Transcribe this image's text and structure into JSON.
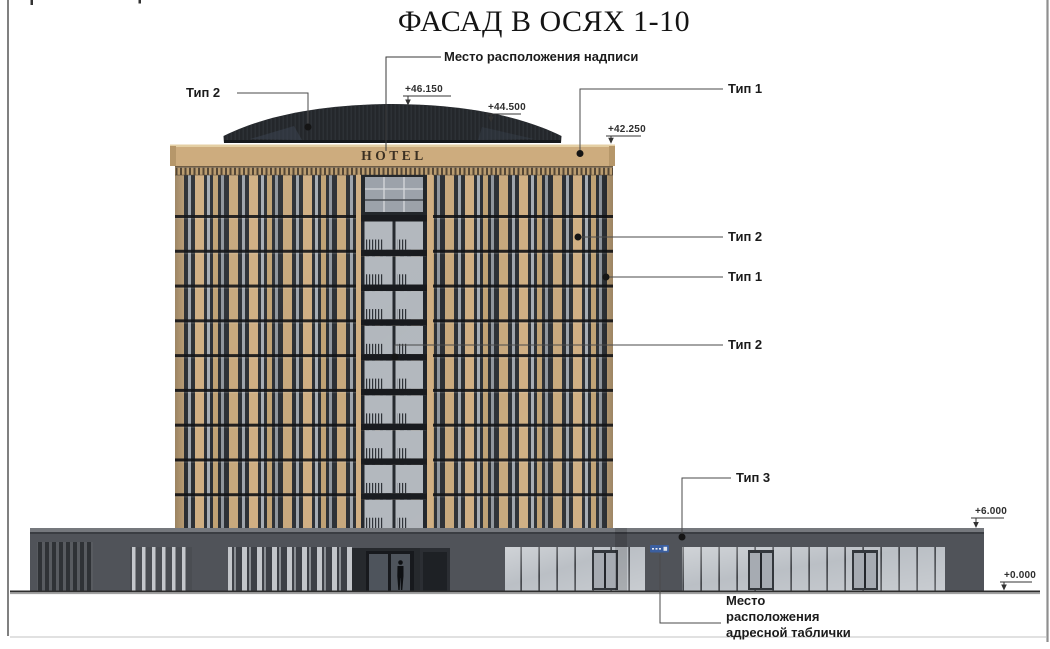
{
  "page": {
    "title": "ФАСАД В ОСЯХ 1-10"
  },
  "building": {
    "sign": "HOTEL"
  },
  "callouts": {
    "inscription_place": "Место расположения надписи",
    "type2_roof": "Тип 2",
    "type1_cornice": "Тип 1",
    "type2_facade_right": "Тип 2",
    "type1_facade_right": "Тип 1",
    "type2_facade_center": "Тип 2",
    "type3_podium": "Тип 3",
    "address_plate": {
      "line1": "Место",
      "line2": "расположения",
      "line3": "адресной таблички"
    }
  },
  "elevations": {
    "roof_peak": "+46.150",
    "roof_eave": "+44.500",
    "cornice_top": "+42.250",
    "podium_top": "+6.000",
    "ground": "+0.000"
  },
  "colors": {
    "facade_beige": "#c7a87c",
    "cornice_beige": "#cdac7e",
    "window_dark": "#2b2f34",
    "glass_light": "#b2b7bd",
    "roof_dark": "#24272b",
    "podium_gray": "#505359",
    "plaque_blue": "#3b5fa0",
    "leader_line": "#4a4a4a",
    "text_dark": "#1b1b1b"
  }
}
